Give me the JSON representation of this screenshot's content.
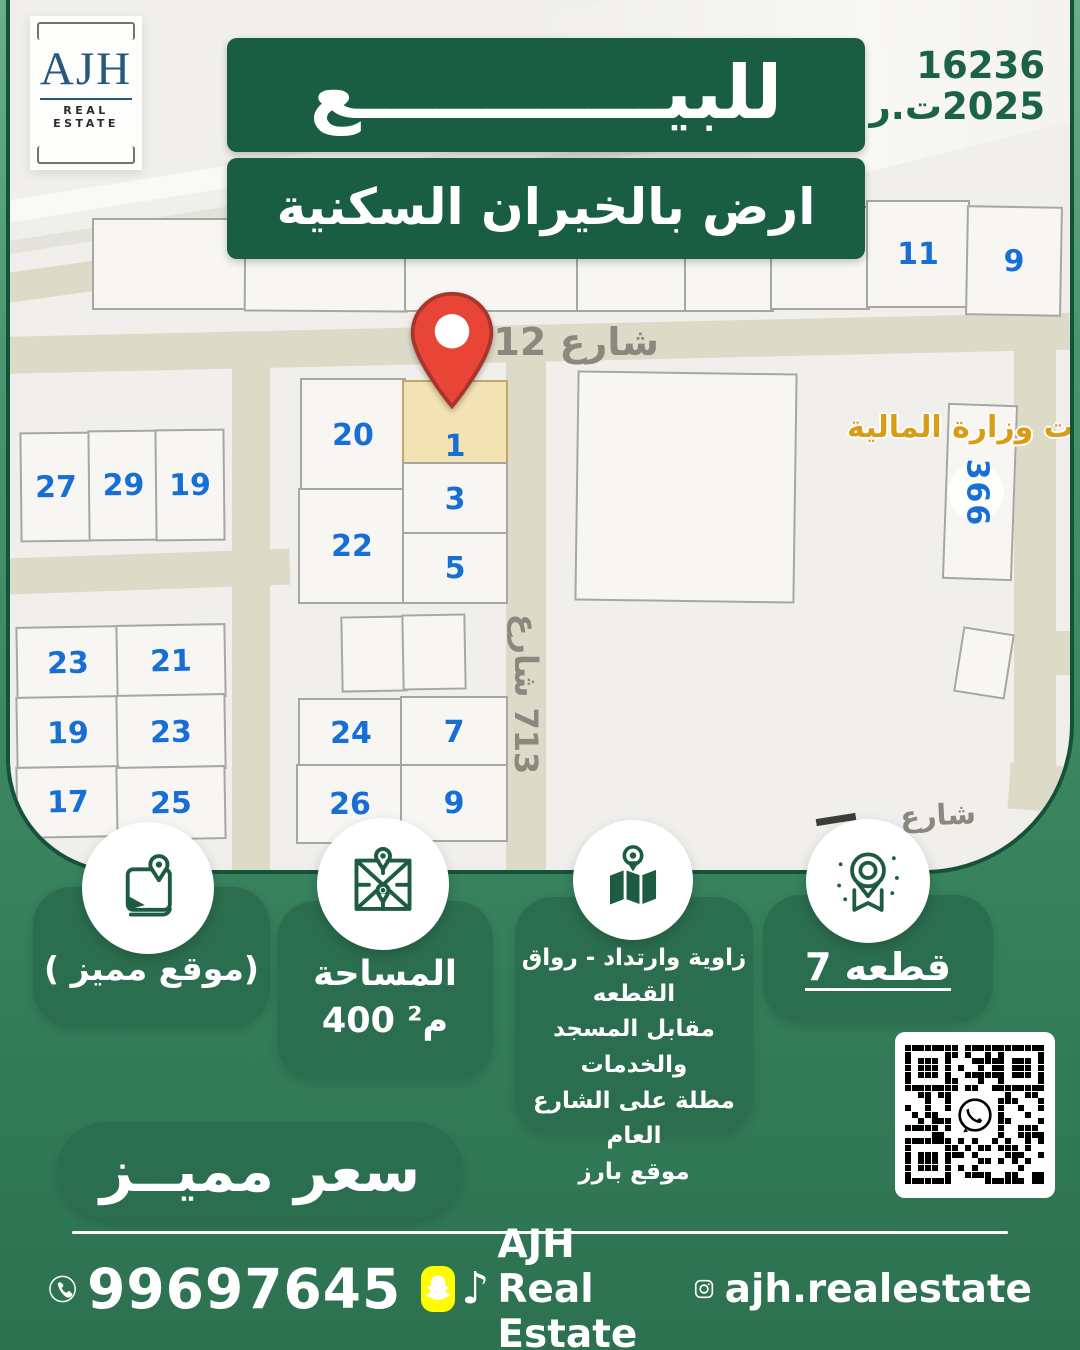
{
  "header": {
    "logo": {
      "brand": "AJH",
      "tagline": "REAL ESTATE"
    },
    "license": {
      "number": "16236",
      "year_ref": "2025ت.ر"
    },
    "title_badge": "للبيــــــــــــع",
    "subtitle_badge": "ارض بالخيران السكنية"
  },
  "map": {
    "street_712": "شارع 712",
    "street_713": {
      "word": "شارع",
      "number": "713"
    },
    "street_bottom": "شارع",
    "landmark_label": "حلات وزارة المالية",
    "parcel_badge": "366",
    "plots": {
      "p11": "11",
      "p9_top": "9",
      "p20": "20",
      "p22": "22",
      "p1": "1",
      "p3": "3",
      "p5": "5",
      "p27": "27",
      "p29": "29",
      "p19_top": "19",
      "p23_a": "23",
      "p21": "21",
      "p19_b": "19",
      "p23_b": "23",
      "p17": "17",
      "p25": "25",
      "p24": "24",
      "p7": "7",
      "p26": "26",
      "p9": "9"
    }
  },
  "features": [
    {
      "icon": "book-map-pin-icon",
      "lines": [
        "(موقع مميز )"
      ]
    },
    {
      "icon": "map-grid-icon",
      "lines": [
        "المساحة",
        "400 م²"
      ]
    },
    {
      "icon": "folded-map-pin-icon",
      "lines": [
        "زاوية وارتداد - رواق",
        "القطعه",
        "مقابل المسجد والخدمات",
        "مطلة على الشارع العام",
        "موقع بارز"
      ]
    },
    {
      "icon": "location-badge-icon",
      "lines": [
        "قطعه 7"
      ]
    }
  ],
  "price_badge": "سعر مميــز",
  "footer": {
    "phone": "99697645",
    "social_handle": "AJH Real Estate",
    "instagram_handle": "ajh.realestate"
  },
  "colors": {
    "brand_green": "#195e42",
    "card_green": "#2b6e4f",
    "plot_number_blue": "#176fd6",
    "pin_red": "#e94536",
    "landmark_orange": "#d99c17",
    "snapchat_yellow": "#fffc00"
  }
}
